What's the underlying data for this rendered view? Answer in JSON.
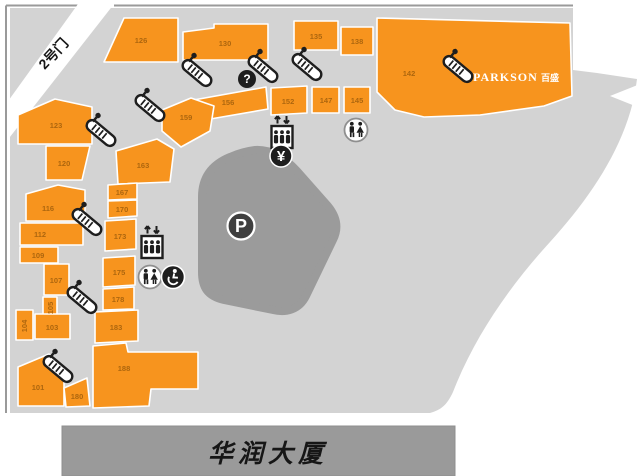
{
  "colors": {
    "store": "#F7941E",
    "store-label": "#AD660E",
    "concourse": "#D3D3D3",
    "parking-structure": "#9B9B9B",
    "building": "#9A9A9A",
    "icon": "#1E1E1E",
    "map-border": "#9A9A9A"
  },
  "gate": {
    "label": "2号门"
  },
  "anchor_store": {
    "name": "PARKSON",
    "name_cn": "百盛"
  },
  "building": {
    "label": "华润大厦"
  },
  "symbols": {
    "parking": "P",
    "information": "?",
    "currency": "¥"
  },
  "icons": {
    "escalator": "escalator-icon",
    "elevator": "elevator-icon",
    "restroom": "restroom-icon",
    "wheelchair_accessible": "wheelchair-icon",
    "information": "info-icon",
    "atm": "atm-icon",
    "parking": "parking-icon"
  },
  "stores": {
    "u101": "101",
    "u103": "103",
    "u104": "104",
    "u105": "105",
    "u107": "107",
    "u109": "109",
    "u112": "112",
    "u116": "116",
    "u120": "120",
    "u123": "123",
    "u126": "126",
    "u130": "130",
    "u135": "135",
    "u138": "138",
    "u142": "142",
    "u145": "145",
    "u147": "147",
    "u152": "152",
    "u156": "156",
    "u159": "159",
    "u163": "163",
    "u167": "167",
    "u170": "170",
    "u173": "173",
    "u175": "175",
    "u178": "178",
    "u180": "180",
    "u183": "183",
    "u188": "188"
  }
}
